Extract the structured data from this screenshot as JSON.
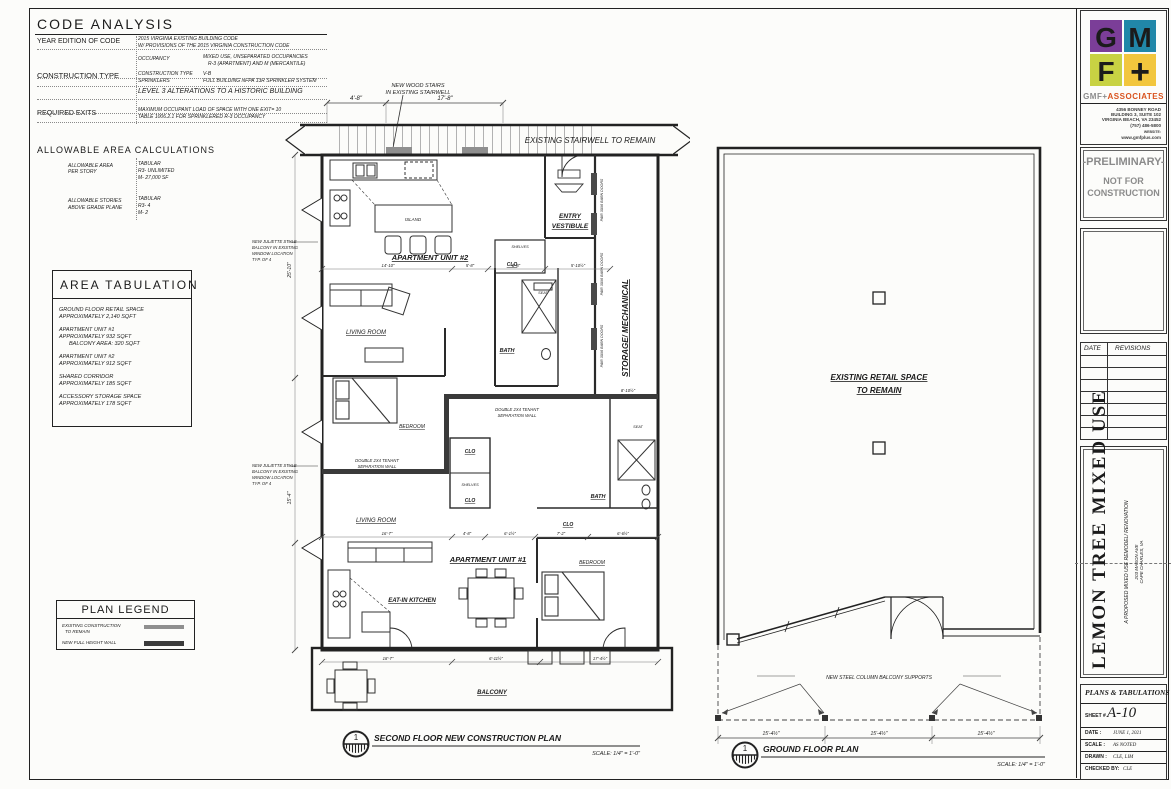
{
  "code_analysis": {
    "title": "CODE ANALYSIS",
    "year_label": "YEAR EDITION OF CODE",
    "year_line1": "2015 VIRGINIA EXISTING BUILDING CODE",
    "year_line2": "W/ PROVISIONS OF THE 2015 VIRGINIA CONSTRUCTION CODE",
    "occupancy_key": "OCCUPANCY",
    "occupancy_line1": "MIXED USE, UNSEPARATED OCCUPANCIES",
    "occupancy_line2": "R-3 (APARTMENT) AND M (MERCANTILE)",
    "construction_label": "CONSTRUCTION TYPE",
    "construction_key": "CONSTRUCTION TYPE",
    "construction_value": "V-B",
    "sprinklers_key": "SPRINKLERS",
    "sprinklers_value": "FULL BUILDING NFPA 13R SPRINKLER SYSTEM",
    "level_note": "LEVEL 3 ALTERATIONS TO A HISTORIC BUILDING",
    "exits_label": "REQUIRED EXITS",
    "exits_line1": "MAXIMUM OCCUPANT LOAD OF SPACE WITH ONE EXIT= 10",
    "exits_line2": "TABLE 1006.2.1 FOR SPRINKLERED R-3 OCCUPANCY",
    "allowable_title": "ALLOWABLE AREA CALCULATIONS",
    "area_label1": "ALLOWABLE AREA",
    "area_label2": "PER STORY",
    "area_value1": "TABULAR",
    "area_value2": "R3- UNLIMITED",
    "area_value3": "M- 27,000 SF",
    "stories_label1": "ALLOWABLE STORIES",
    "stories_label2": "ABOVE GRADE PLANE",
    "stories_value1": "TABULAR",
    "stories_value2": "R3- 4",
    "stories_value3": "M- 2"
  },
  "area_tabulation": {
    "title": "AREA TABULATION",
    "entries": [
      {
        "l1": "GROUND FLOOR RETAIL SPACE",
        "l2": "APPROXIMATELY 2,140 SQFT",
        "l3": ""
      },
      {
        "l1": "APARTMENT UNIT #1",
        "l2": "APPROXIMATELY 932 SQFT",
        "l3": "BALCONY AREA: 320 SQFT"
      },
      {
        "l1": "APARTMENT UNIT #2",
        "l2": "APPROXIMATELY 912 SQFT",
        "l3": ""
      },
      {
        "l1": "SHARED CORRIDOR",
        "l2": "APPROXIMATELY 185 SQFT",
        "l3": ""
      },
      {
        "l1": "ACCESSORY STORAGE SPACE",
        "l2": "APPROXIMATELY 178 SQFT",
        "l3": ""
      }
    ]
  },
  "plan_legend": {
    "title": "PLAN LEGEND",
    "item1_line1": "EXISTING CONSTRUCTION",
    "item1_line2": "TO REMAIN",
    "item2": "NEW FULL HEIGHT WALL"
  },
  "second_floor": {
    "marker": "1",
    "title": "SECOND FLOOR NEW CONSTRUCTION PLAN",
    "scale": "SCALE: 1/4\" = 1'-0\"",
    "stairs_note1": "NEW WOOD STAIRS",
    "stairs_note2": "IN EXISTING STAIRWELL",
    "stairwell": "EXISTING STAIRWELL TO REMAIN",
    "rooms": {
      "island": "ISLAND",
      "unit2": "APARTMENT UNIT #2",
      "entry1": "ENTRY",
      "entry2": "VESTIBULE",
      "storage": "STORAGE/ MECHANICAL",
      "living": "LIVING ROOM",
      "bath": "BATH",
      "bedroom": "BEDROOM",
      "clo": "CLO",
      "shelves": "SHELVES",
      "seat": "SEAT",
      "unit1": "APARTMENT UNIT #1",
      "eatin": "EAT-IN KITCHEN",
      "balcony": "BALCONY"
    },
    "juliette1": "NEW JULIETTE STYLE",
    "juliette2": "BALCONY IN EXISTING",
    "juliette3": "WINDOW LOCATION",
    "juliette4": "TYP. OF 4",
    "separation1": "DOUBLE 2X4 TENANT",
    "separation2": "SEPARATION WALL",
    "barn_doors": "PAIR 30X6 BARN DOORS",
    "dims": {
      "top1": "4'-8\"",
      "top2": "17'-8\"",
      "left1": "25'-10\"",
      "left2": "15'-4\"",
      "storage1": "8'-10½\"",
      "kitchen_row": [
        "14'-10\"",
        "5'-8\"",
        "8'-8\"",
        "5'-10½\""
      ],
      "mid_row": [
        "16'-7\"",
        "4'-8\"",
        "6'-1½\"",
        "7'-2\"",
        "6'-6½\""
      ],
      "balcony_row": [
        "18'-7\"",
        "6'-11½\"",
        "17'-4½\""
      ]
    }
  },
  "ground_floor": {
    "marker": "1",
    "title": "GROUND FLOOR PLAN",
    "scale": "SCALE: 1/4\" = 1'-0\"",
    "room1": "EXISTING RETAIL SPACE",
    "room2": "TO REMAIN",
    "supports_note": "NEW STEEL COLUMN BALCONY SUPPORTS",
    "dims": [
      "15'-4½\"",
      "15'-4½\"",
      "15'-4½\""
    ]
  },
  "title_block": {
    "logo": {
      "g": "G",
      "m": "M",
      "f": "F",
      "plus": "+",
      "colors": {
        "g": "#7b3e98",
        "m": "#2187a8",
        "f": "#c8d243",
        "plus": "#f2c63d",
        "plus_glyph": "#e08b28"
      }
    },
    "firm_name_gray": "GMF+",
    "firm_name_red": "ASSOCIATES",
    "address1": "4356 BONNEY ROAD",
    "address2": "BUILDING 3, SUITE 102",
    "address3": "VIRGINIA BEACH, VA 23452",
    "address4": "(757) 486-5800",
    "website_label": "WEBSITE:",
    "website": "www.gmfplus.com",
    "preliminary": "-PRELIMINARY-",
    "not_for1": "NOT FOR",
    "not_for2": "CONSTRUCTION",
    "rev_date_header": "DATE",
    "rev_header": "REVISIONS",
    "project_title": "LEMON TREE MIXED USE",
    "project_subtitle": "A PROPOSED MIXED USE REMODEL/ RENOVATION",
    "project_address1": "203 MASON AVE",
    "project_address2": "CAPE CHARLES, VA",
    "sheet_type": "PLANS & TABULATIONS",
    "sheet_label": "SHEET #",
    "sheet_number": "A-10",
    "date_label": "DATE :",
    "date_value": "JUNE 1, 2021",
    "scale_label": "SCALE :",
    "scale_value": "AS NOTED",
    "drawn_label": "DRAWN :",
    "drawn_value": "CLE, LIM",
    "checked_label": "CHECKED BY:",
    "checked_value": "CLE"
  }
}
